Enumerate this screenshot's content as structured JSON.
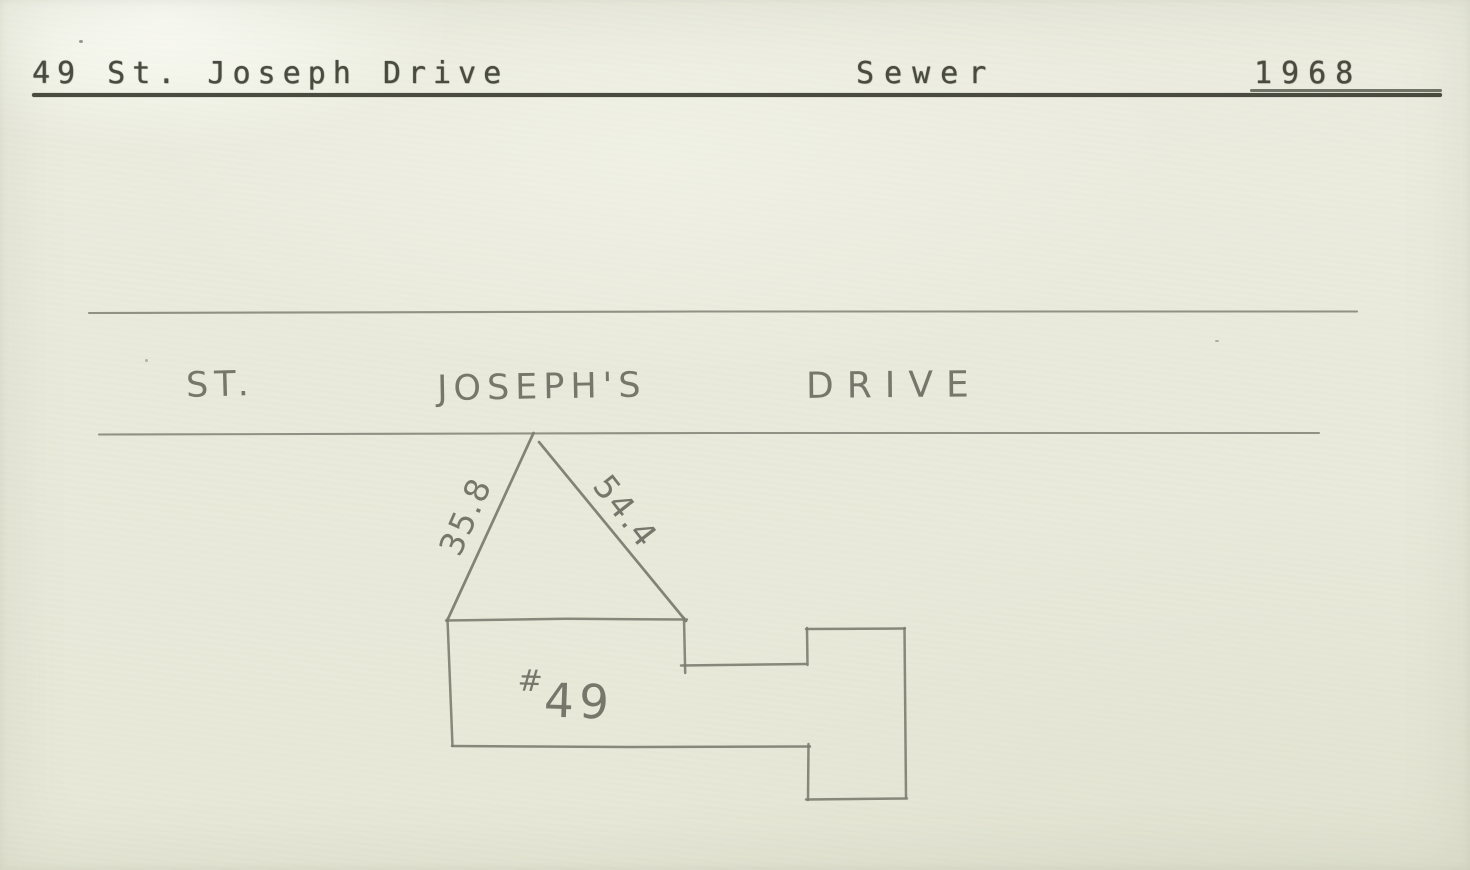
{
  "colors": {
    "paper": "#e9eadb",
    "pencil": "#7c7d70",
    "pencil_text": "#6d6e62",
    "ink": "#4a4b40"
  },
  "header": {
    "address": "49 St. Joseph Drive",
    "doc_type": "Sewer",
    "year": "1968"
  },
  "diagram": {
    "street_name": {
      "word_1": "ST.",
      "word_2": "JOSEPH'S",
      "word_3": "DRIVE"
    },
    "measurements": {
      "left_leg": "35.8",
      "right_leg": "54.4"
    },
    "house": {
      "number_prefix": "#",
      "number": "49"
    }
  }
}
